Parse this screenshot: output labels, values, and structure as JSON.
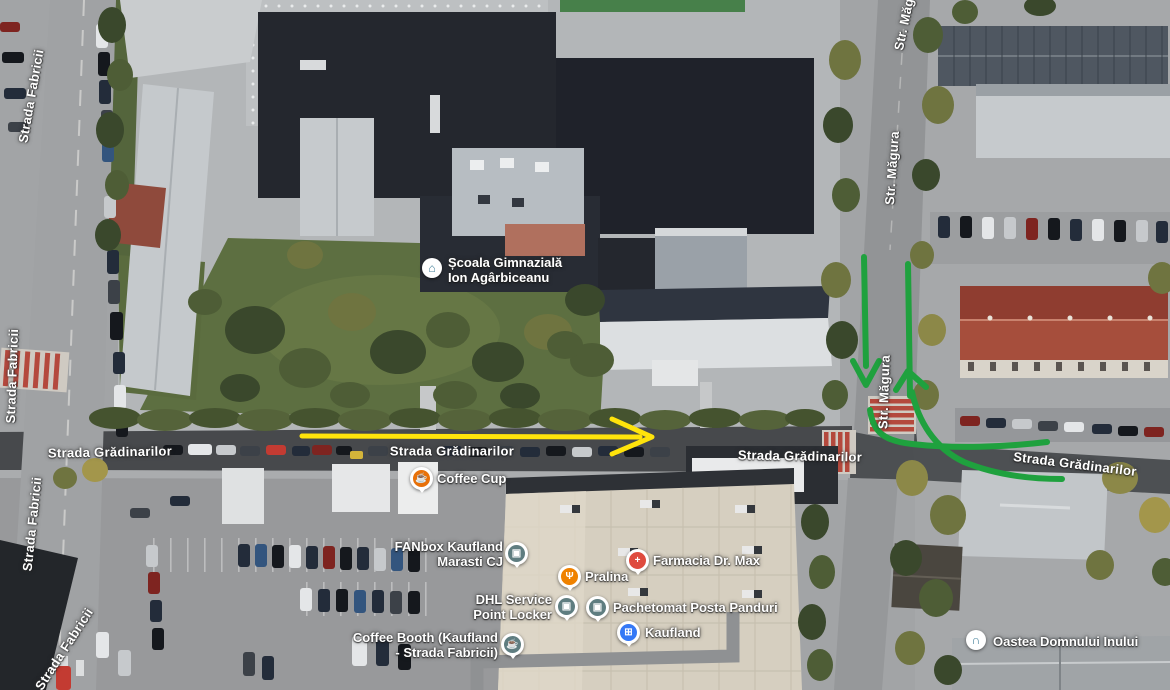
{
  "map_type": "satellite",
  "streets": [
    {
      "label": "Strada Fabricii"
    },
    {
      "label": "Strada Fabricii"
    },
    {
      "label": "Strada Fabricii"
    },
    {
      "label": "Strada Fabricii"
    },
    {
      "label": "Strada Grădinarilor"
    },
    {
      "label": "Strada Grădinarilor"
    },
    {
      "label": "Strada Grădinarilor"
    },
    {
      "label": "Strada Grădinarilor"
    },
    {
      "label": "Str. Măgura"
    },
    {
      "label": "Str. Măgura"
    },
    {
      "label": "Str. Măgura"
    }
  ],
  "pois": {
    "school": {
      "line1": "Școala Gimnazială",
      "line2": "Ion Agârbiceanu",
      "icon": "school-icon",
      "icon_glyph": "⌂",
      "icon_color": "#3f7e97",
      "style": "white-badge"
    },
    "coffee_cup": {
      "label": "Coffee Cup",
      "icon": "coffee-icon",
      "icon_glyph": "☕",
      "pin_color": "#e8710a"
    },
    "fanbox": {
      "line1": "FANbox Kaufland",
      "line2": "Marasti CJ",
      "icon": "parcel-locker-icon",
      "icon_glyph": "▣",
      "pin_color": "#5f7d80"
    },
    "farmacia": {
      "label": "Farmacia Dr. Max",
      "icon": "pharmacy-icon",
      "icon_glyph": "+",
      "pin_color": "#df4b3e"
    },
    "pralina": {
      "label": "Pralina",
      "icon": "food-icon",
      "icon_glyph": "Ψ",
      "pin_color": "#ef8200"
    },
    "dhl": {
      "line1": "DHL Service",
      "line2": "Point Locker",
      "icon": "parcel-locker-icon",
      "icon_glyph": "▣",
      "pin_color": "#5f7d80"
    },
    "pachetomat": {
      "label": "Pachetomat Posta Panduri",
      "icon": "parcel-locker-icon",
      "icon_glyph": "▣",
      "pin_color": "#5f7d80"
    },
    "kaufland": {
      "label": "Kaufland",
      "icon": "shopping-cart-icon",
      "icon_glyph": "⊞",
      "pin_color": "#3478f6"
    },
    "coffee_booth": {
      "line1": "Coffee Booth (Kaufland",
      "line2": "- Strada Fabricii)",
      "icon": "coffee-icon",
      "icon_glyph": "☕",
      "pin_color": "#5f7d80"
    },
    "oastea": {
      "label": "Oastea Domnului Inului",
      "icon": "organization-icon",
      "icon_glyph": "∩",
      "icon_color": "#3f7e97",
      "style": "white-badge"
    }
  },
  "annotations": {
    "yellow_arrow": {
      "color": "#ffe30b",
      "direction": "west-to-east along Strada Grădinarilor"
    },
    "green_routes": {
      "color": "#1fa13e",
      "down_arrow": "southbound on Str. Măgura",
      "up_arrow": "northbound on Str. Măgura",
      "curves": "turns between Str. Măgura and Strada Grădinarilor east"
    }
  }
}
